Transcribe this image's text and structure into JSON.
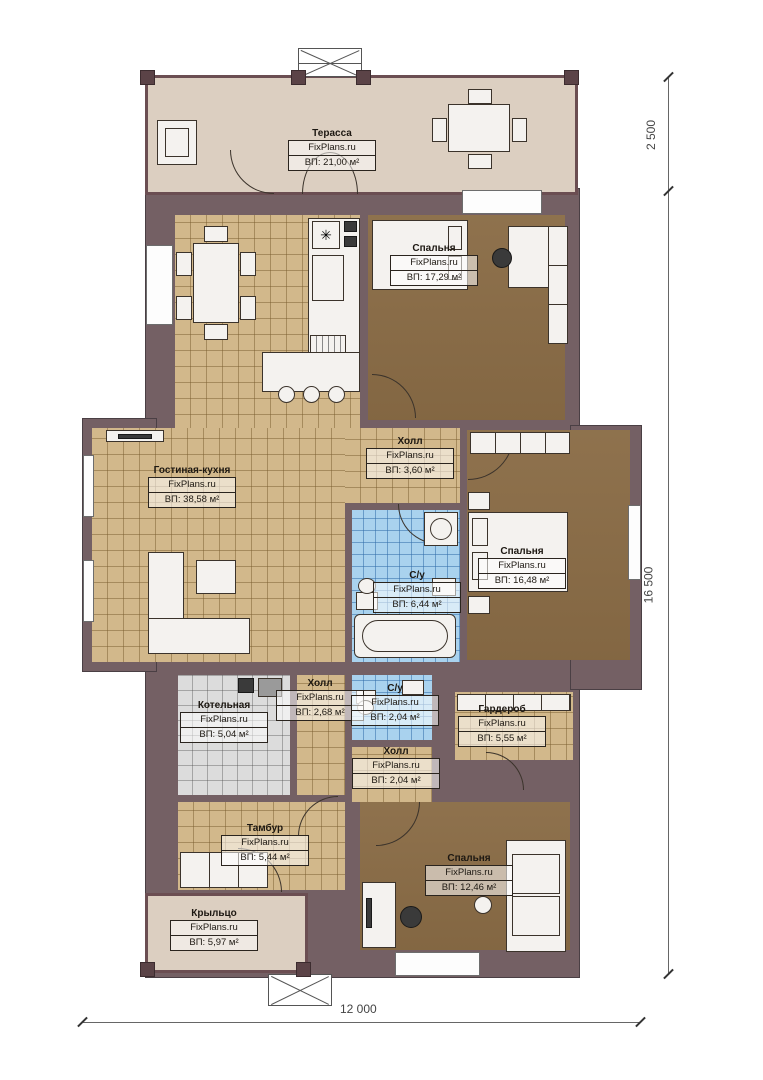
{
  "brand": "FixPlans.ru",
  "rooms": [
    {
      "key": "terrace",
      "name": "Терасса",
      "brand": "FixPlans.ru",
      "area": "ВП: 21,00 м²"
    },
    {
      "key": "bedroom-top",
      "name": "Спальня",
      "brand": "FixPlans.ru",
      "area": "ВП: 17,29 м²"
    },
    {
      "key": "hall-main",
      "name": "Холл",
      "brand": "FixPlans.ru",
      "area": "ВП: 3,60 м²"
    },
    {
      "key": "living-kitchen",
      "name": "Гостиная-кухня",
      "brand": "FixPlans.ru",
      "area": "ВП: 38,58 м²"
    },
    {
      "key": "bedroom-right",
      "name": "Спальня",
      "brand": "FixPlans.ru",
      "area": "ВП: 16,48 м²"
    },
    {
      "key": "bathroom-main",
      "name": "С/у",
      "brand": "FixPlans.ru",
      "area": "ВП: 6,44 м²"
    },
    {
      "key": "boiler-room",
      "name": "Котельная",
      "brand": "FixPlans.ru",
      "area": "ВП: 5,04 м²"
    },
    {
      "key": "hall-small",
      "name": "Холл",
      "brand": "FixPlans.ru",
      "area": "ВП: 2,68 м²"
    },
    {
      "key": "bathroom-small",
      "name": "С/у",
      "brand": "FixPlans.ru",
      "area": "ВП: 2,04 м²"
    },
    {
      "key": "wardrobe",
      "name": "Гардероб",
      "brand": "FixPlans.ru",
      "area": "ВП: 5,55 м²"
    },
    {
      "key": "hall-rear",
      "name": "Холл",
      "brand": "FixPlans.ru",
      "area": "ВП: 2,04 м²"
    },
    {
      "key": "tambour",
      "name": "Тамбур",
      "brand": "FixPlans.ru",
      "area": "ВП: 5,44 м²"
    },
    {
      "key": "porch",
      "name": "Крыльцо",
      "brand": "FixPlans.ru",
      "area": "ВП: 5,97 м²"
    },
    {
      "key": "bedroom-bottom",
      "name": "Спальня",
      "brand": "FixPlans.ru",
      "area": "ВП: 12,46 м²"
    }
  ],
  "dimensions": {
    "terrace_depth": "2 500",
    "house_length": "16 500",
    "house_width": "12 000"
  },
  "colors": {
    "wall": "#746064",
    "tile_tan": "#d2b88b",
    "floor_brown": "#8a6c46",
    "bath_blue": "#a9d2ee",
    "boiler_gray": "#dcdcdc",
    "terrace_beige": "#dccfc1",
    "dimension_line": "#666666"
  }
}
